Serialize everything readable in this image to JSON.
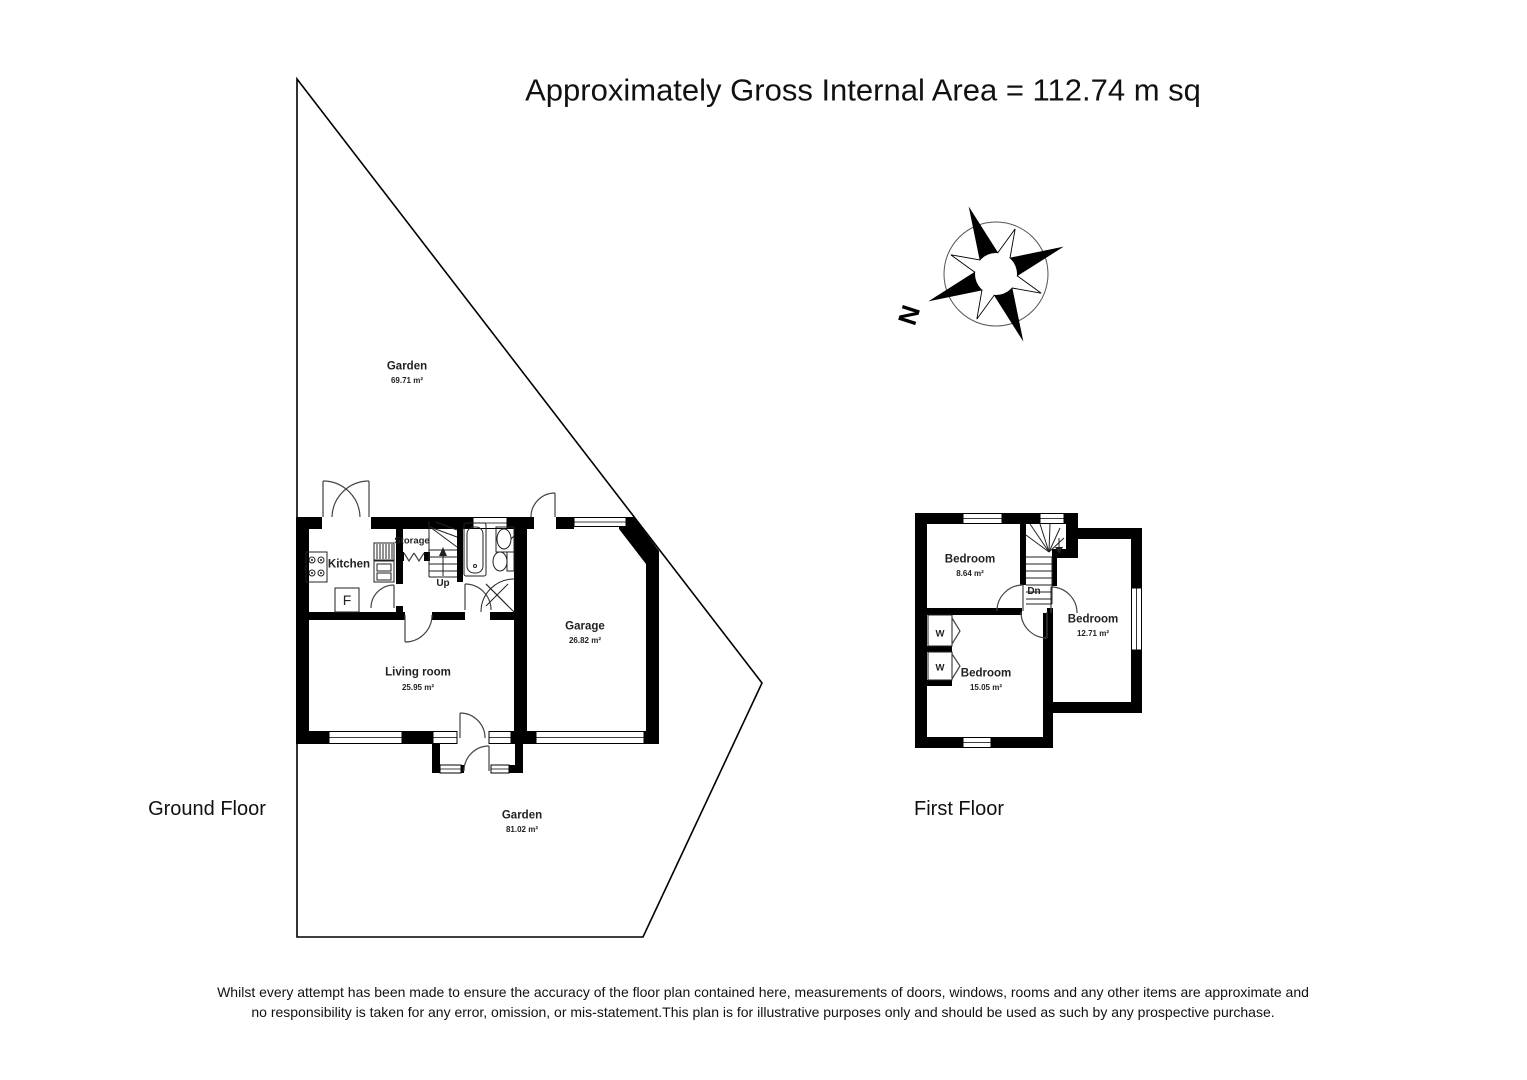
{
  "title": "Approximately Gross Internal Area = 112.74 m sq",
  "compass": {
    "north_label": "N"
  },
  "ground_floor": {
    "label": "Ground Floor",
    "garden_top": {
      "name": "Garden",
      "area": "69.71 m²"
    },
    "garden_bottom": {
      "name": "Garden",
      "area": "81.02 m²"
    },
    "kitchen": {
      "name": "Kitchen"
    },
    "storage": {
      "name": "Storage"
    },
    "stairs_label": "Up",
    "fridge_label": "F",
    "living_room": {
      "name": "Living room",
      "area": "25.95 m²"
    },
    "garage": {
      "name": "Garage",
      "area": "26.82 m²"
    }
  },
  "first_floor": {
    "label": "First Floor",
    "bedroom_small": {
      "name": "Bedroom",
      "area": "8.64 m²"
    },
    "bedroom_right": {
      "name": "Bedroom",
      "area": "12.71 m²"
    },
    "bedroom_large": {
      "name": "Bedroom",
      "area": "15.05 m²"
    },
    "stairs_label": "Dn",
    "wardrobes": [
      "W",
      "W"
    ]
  },
  "disclaimer": {
    "line1": "Whilst every attempt has been made to ensure the accuracy of the floor plan contained here, measurements of doors, windows, rooms and any other items are approximate and",
    "line2": "no responsibility is taken for any error, omission, or mis-statement.This plan is for illustrative purposes only and should be used as such by any prospective purchase."
  }
}
